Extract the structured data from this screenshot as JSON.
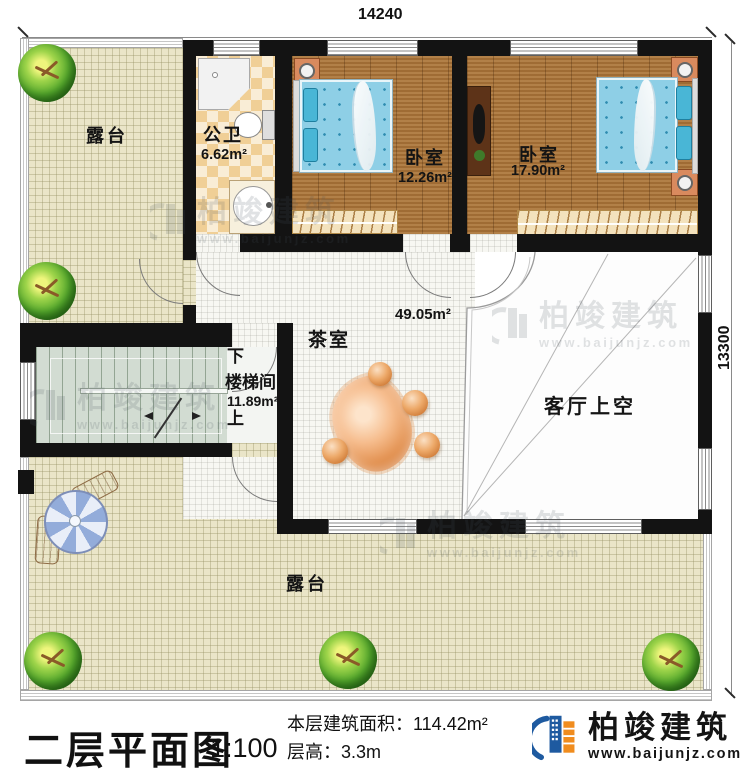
{
  "dimensions": {
    "top": "14240",
    "right": "13300"
  },
  "rooms": {
    "terrace_top": {
      "label": "露台"
    },
    "bathroom": {
      "label": "公卫",
      "area": "6.62m²"
    },
    "bedroom_small": {
      "label": "卧室",
      "area": "12.26m²"
    },
    "bedroom_large": {
      "label": "卧室",
      "area": "17.90m²"
    },
    "tea_room": {
      "label": "茶室",
      "area": "49.05m²"
    },
    "stairwell": {
      "label": "楼梯间",
      "area": "11.89m²",
      "down": "下",
      "up": "上"
    },
    "living_void": {
      "label": "客厅上空"
    },
    "terrace_bottom": {
      "label": "露台"
    }
  },
  "title_block": {
    "title": "二层平面图",
    "scale": "1:100",
    "floor_area_label": "本层建筑面积：",
    "floor_area_value": "114.42m²",
    "floor_height_label": "层高：",
    "floor_height_value": "3.3m"
  },
  "branding": {
    "company": "柏竣建筑",
    "website": "www.baijunjz.com"
  },
  "watermark": {
    "company": "柏竣建筑",
    "website": "www.baijunjz.com"
  },
  "colors": {
    "wall": "#131313",
    "wood_floor": "#a9743a",
    "terrace_floor": "#eae5c8",
    "tile_floor": "#f7f7f2",
    "stair_floor": "#d2dcd2",
    "bed": "#8ecfe6",
    "bath_checker": "#f0cf96",
    "logo_blue": "#1e5aa0",
    "logo_orange": "#f08c1e"
  }
}
